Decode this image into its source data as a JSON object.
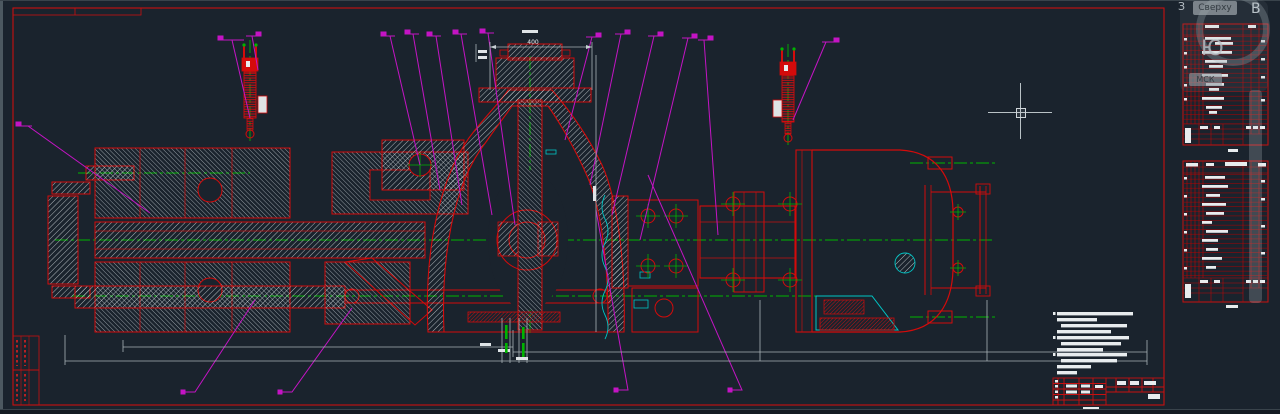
{
  "viewcube": {
    "top": "Сверху",
    "west": "З",
    "east": "В",
    "south": "Ю",
    "ucs": "МСК"
  },
  "canvas": {
    "dim_top_label": "400"
  },
  "colors": {
    "background": "#1a232d",
    "frame_red": "#c81010",
    "entity_red": "#d40b0b",
    "centerline_green": "#00b400",
    "leader_magenta": "#c414c4",
    "aux_cyan": "#00c4c4",
    "hatch_white": "#d6dcdf",
    "dim_gray": "#a9b3b7"
  }
}
